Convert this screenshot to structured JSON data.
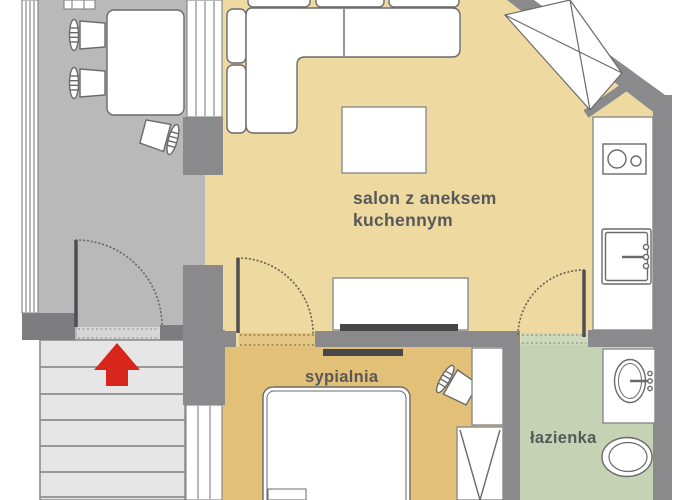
{
  "labels": {
    "living_room_line1": "salon z aneksem",
    "living_room_line2": "kuchennym",
    "bedroom": "sypialnia",
    "bathroom": "łazienka"
  },
  "icons": {
    "entrance_arrow": "up-arrow entrance direction",
    "window_cross": "window-x symbol",
    "door_arc": "door swing arc"
  },
  "colors": {
    "living_floor": "#eed9a1",
    "bedroom_floor": "#e3c077",
    "bathroom_floor": "#c6d2b4",
    "hall_floor": "#b9b9ba",
    "wall": "#8a8a8c",
    "wall_dark": "#7d7d7f",
    "stairs_fill": "#e6e6e7",
    "stairs_line": "#8e8e90",
    "arrow_red": "#d8261d",
    "furniture_outline": "#6a6a6a",
    "fixture_outline": "#8a8a8c",
    "tv_bar": "#47474a",
    "label_text": "#58585a",
    "threshold_entry": "#d6d6d7",
    "threshold_bedroom": "#e3c584",
    "threshold_bath": "#cdd8bd"
  }
}
